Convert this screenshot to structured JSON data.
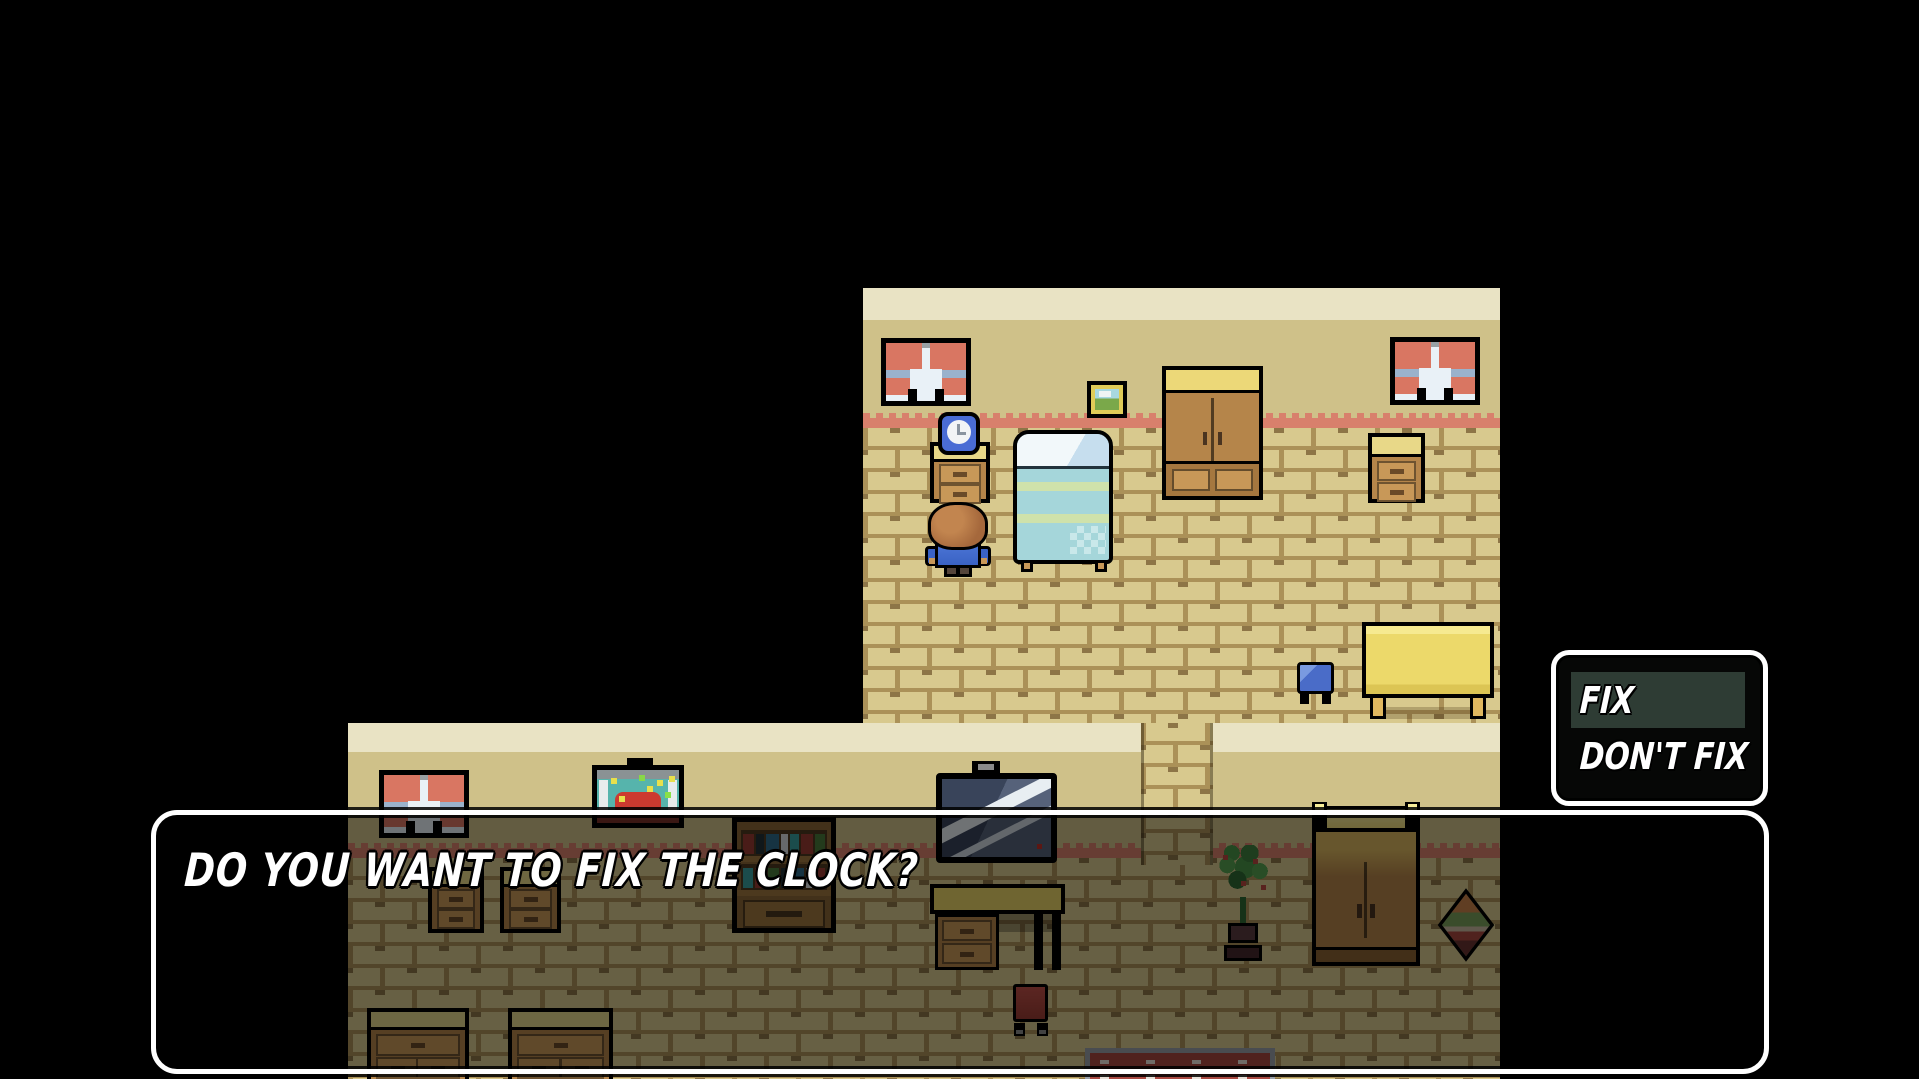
{
  "screen": {
    "width": 1919,
    "height": 1079,
    "background": "#000000"
  },
  "dialog": {
    "text": "DO YOU WANT TO FIX THE CLOCK?",
    "text_color": "#ffffff",
    "border_color": "#ffffff",
    "fill": "rgba(0,0,0,0.52)"
  },
  "choice_menu": {
    "selected_index": 0,
    "highlight_color": "#2e3c34",
    "options": [
      {
        "label": "FIX",
        "selected": true
      },
      {
        "label": "DON'T FIX",
        "selected": false
      }
    ]
  },
  "palette": {
    "wall_top": "#e9e3c4",
    "wall": "#cfc189",
    "wall_trim_scallop": "#d8806c",
    "floor_brick": "#d8c98e",
    "floor_mortar": "#ab9158",
    "curtain_red": "#d97662",
    "bed_blue": "#a5d6da",
    "clock_blue": "#4a6cd4",
    "wood": "#b5854a",
    "wood_top": "#e8d888"
  },
  "scene": {
    "upper_room_objects": [
      "window",
      "window",
      "picture-frame",
      "wardrobe",
      "nightstand",
      "alarm-clock",
      "bed",
      "player-character",
      "side-table",
      "blue-stool",
      "nightstand"
    ],
    "lower_room_objects": [
      "window",
      "crab-painting",
      "bookshelf",
      "television",
      "desk",
      "red-chair",
      "rug",
      "potted-plant",
      "glowing-wardrobe",
      "basket",
      "nightstand",
      "nightstand",
      "dresser",
      "dresser",
      "doorway"
    ]
  }
}
